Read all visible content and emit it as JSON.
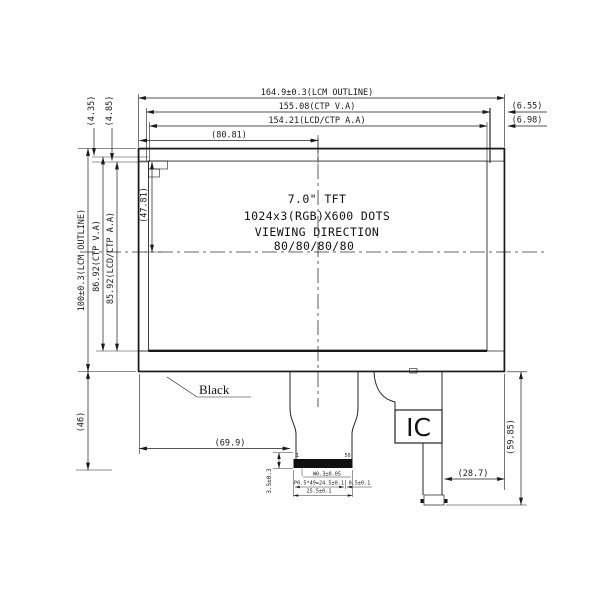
{
  "drawing": {
    "background": "#ffffff",
    "line_color": "#1a1a1a",
    "display_text": {
      "size": "7.0\" TFT",
      "resolution": "1024x3(RGB)X600 DOTS",
      "viewing": "VIEWING DIRECTION",
      "angles": "80/80/80/80"
    },
    "labels": {
      "black_mask": "Black",
      "ic": "IC",
      "pin_first": "1",
      "pin_last": "50"
    },
    "dims": {
      "lcm_width": "164.9±0.3(LCM OUTLINE)",
      "ctp_va_width": "155.08(CTP V.A)",
      "lcd_aa_width": "154.21(LCD/CTP A.A)",
      "center_offset": "(80.81)",
      "gap_right_va": "(6.55)",
      "gap_right_aa": "(6.98)",
      "lcm_height": "100±0.3(LCM OUTLINE)",
      "ctp_va_height": "86.92(CTP V.A)",
      "lcd_aa_height": "85.92(LCD/CTP A.A)",
      "center_half_height": "(47.81)",
      "gap_top_va": "(4.35)",
      "gap_top_aa": "(4.85)",
      "bottom_zone_height": "(46)",
      "fpc_offset": "(69.9)",
      "fpc_stiffener": "3.5±0.3",
      "pad_width": "W0.3±0.05",
      "pad_pitch": "P0.5*49=24.5±0.1",
      "connector_width": "25.5±0.1",
      "pad_margin": "0.5±0.1",
      "ic_tail_offset": "(28.7)",
      "ic_tail_height": "(59.85)"
    }
  }
}
